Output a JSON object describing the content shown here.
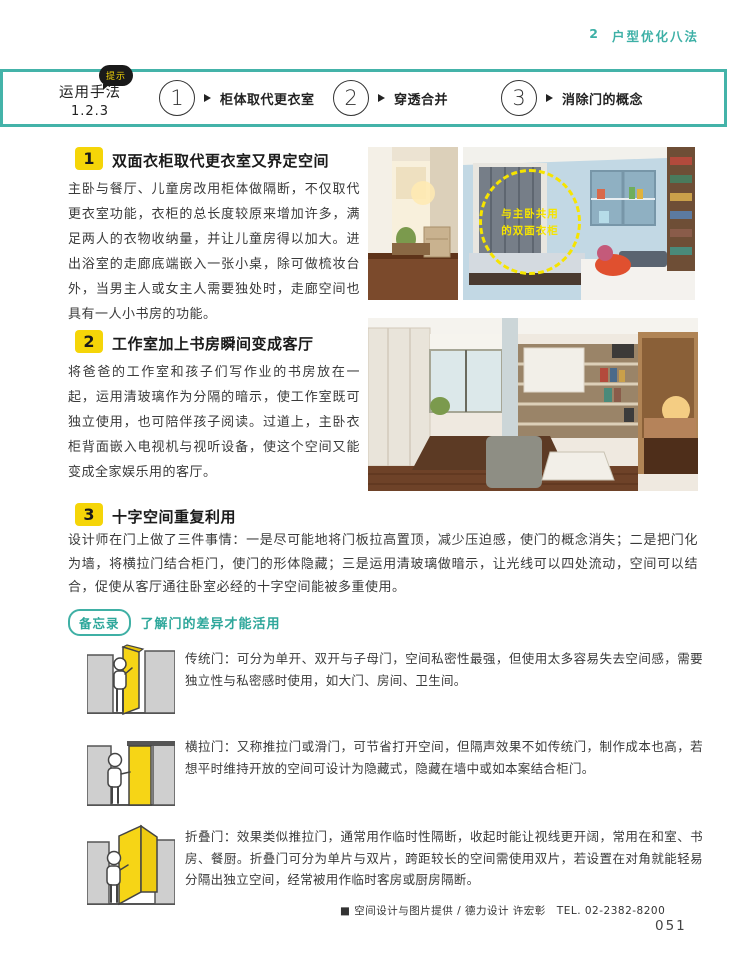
{
  "header": {
    "chapter_num": "2",
    "chapter_title": "户型优化八法"
  },
  "band": {
    "bubble": "提示",
    "title": "运用手法",
    "subtitle": "1.2.3",
    "steps": [
      {
        "num": "1",
        "label": "柜体取代更衣室"
      },
      {
        "num": "2",
        "label": "穿透合并"
      },
      {
        "num": "3",
        "label": "消除门的概念"
      }
    ]
  },
  "sections": [
    {
      "num": "1",
      "title": "双面衣柜取代更衣室又界定空间",
      "body": "主卧与餐厅、儿童房改用柜体做隔断，不仅取代更衣室功能，衣柜的总长度较原来增加许多，满足两人的衣物收纳量，并让儿童房得以加大。进出浴室的走廊底端嵌入一张小桌，除可做梳妆台外，当男主人或女主人需要独处时，走廊空间也具有一人小书房的功能。"
    },
    {
      "num": "2",
      "title": "工作室加上书房瞬间变成客厅",
      "body": "将爸爸的工作室和孩子们写作业的书房放在一起，运用清玻璃作为分隔的暗示，使工作室既可独立使用，也可陪伴孩子阅读。过道上，主卧衣柜背面嵌入电视机与视听设备，使这个空间又能变成全家娱乐用的客厅。"
    },
    {
      "num": "3",
      "title": "十字空间重复利用",
      "body": "设计师在门上做了三件事情：一是尽可能地将门板拉高置顶，减少压迫感，使门的概念消失；二是把门化为墙，将横拉门结合柜门，使门的形体隐藏；三是运用清玻璃做暗示，让光线可以四处流动，空间可以结合，促使从客厅通往卧室必经的十字空间能被多重使用。"
    }
  ],
  "photos": {
    "annotation": {
      "line1": "与主卧共用",
      "line2": "的双面衣柜"
    }
  },
  "memo": {
    "badge": "备忘录",
    "title": "了解门的差异才能活用",
    "items": [
      {
        "name": "传统门",
        "text": "传统门：可分为单开、双开与子母门，空间私密性最强，但使用太多容易失去空间感，需要独立性与私密感时使用，如大门、房间、卫生间。"
      },
      {
        "name": "横拉门",
        "text": "横拉门：又称推拉门或滑门，可节省打开空间，但隔声效果不如传统门，制作成本也高，若想平时维持开放的空间可设计为隐藏式，隐藏在墙中或如本案结合柜门。"
      },
      {
        "name": "折叠门",
        "text": "折叠门：效果类似推拉门，通常用作临时性隔断，收起时能让视线更开阔，常用在和室、书房、餐厨。折叠门可分为单片与双片，跨距较长的空间需使用双片，若设置在对角就能轻易分隔出独立空间，经常被用作临时客房或厨房隔断。"
      }
    ]
  },
  "credit": {
    "text": "■ 空间设计与图片提供 / 德力设计 许宏彰　TEL. 02-2382-8200"
  },
  "page_number": "051",
  "colors": {
    "accent_teal": "#44b3a9",
    "accent_yellow": "#f5d508"
  }
}
